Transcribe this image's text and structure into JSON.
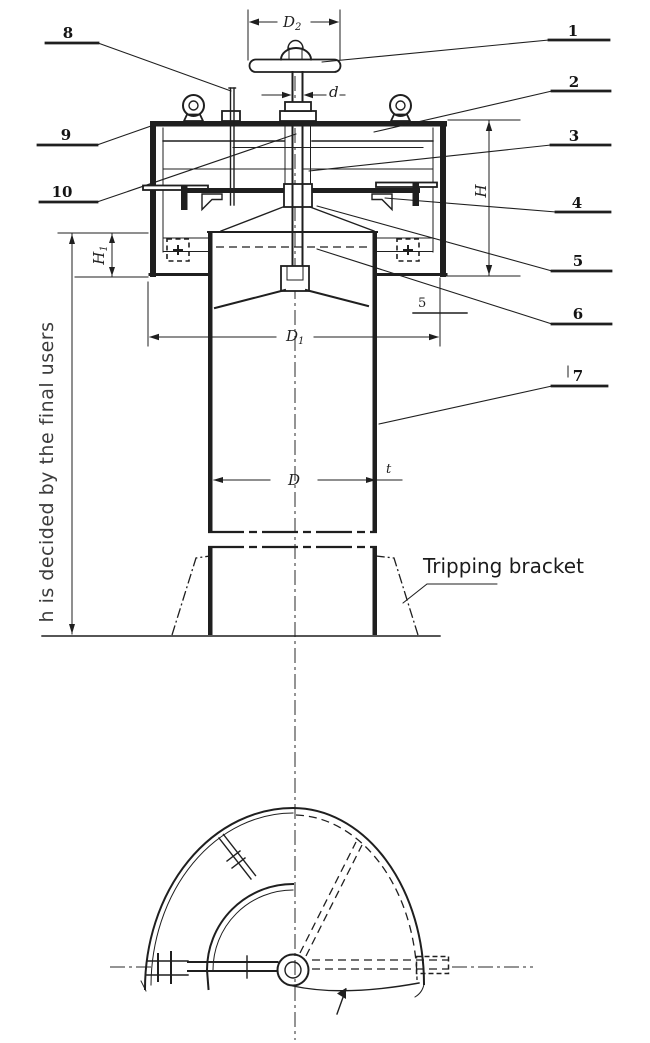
{
  "colors": {
    "ink": "#1f1f1f",
    "note_text": "#3c3c3c",
    "background": "#ffffff"
  },
  "callouts": {
    "n1": "1",
    "n2": "2",
    "n3": "3",
    "n4": "4",
    "n5": "5",
    "n6": "6",
    "n7": "7",
    "n8": "8",
    "n9": "9",
    "n10": "10"
  },
  "dimensions": {
    "d2": {
      "base": "D",
      "sub": "2"
    },
    "d": "d",
    "H": "H",
    "h1": {
      "base": "H",
      "sub": "1"
    },
    "d1": {
      "base": "D",
      "sub": "1"
    },
    "D": "D",
    "t": "t",
    "plate_thickness": "5"
  },
  "annotations": {
    "height_note": "h is decided by the final users",
    "tripping_bracket": "Tripping bracket"
  }
}
